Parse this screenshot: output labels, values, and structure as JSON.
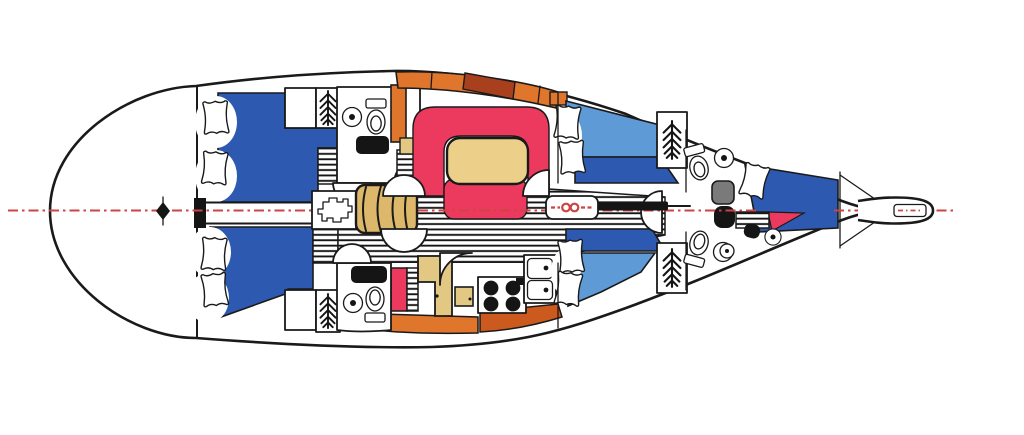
{
  "meta": {
    "title": "Sailboat interior accommodation plan (top view, bow right)",
    "diagram_type": "yacht-deck-plan"
  },
  "colors": {
    "hull_line": "#1a1a1a",
    "berth_dark_blue": "#2d5ab0",
    "berth_light_blue": "#5e9bd6",
    "settee_crimson": "#ec3a5e",
    "locker_crimson": "#ec3a5e",
    "triangle_crimson": "#ec3a5e",
    "table_tan": "#ecd089",
    "nav_tan": "#e3c883",
    "steps_tan": "#ddb76a",
    "cabinet_orange": "#e0752c",
    "counter_rust": "#cc5a1f",
    "cabinet_brown": "#a8401e",
    "shower_gray": "#7a7a7a",
    "centerline_red": "#cc4444",
    "floor_stripe": "#161616"
  },
  "regions": {
    "aft_deck": "aft-deck",
    "aft_cabin_top": "aft-double-cabin-top",
    "aft_cabin_bottom": "aft-double-cabin-bottom",
    "aft_head_top": "aft-head-top",
    "head_bottom": "head-bottom-galley-side",
    "saloon": "saloon-settee-and-table",
    "galley": "galley",
    "nav_station": "nav-station",
    "companionway": "companionway-steps",
    "engine_hatch": "engine-hatch",
    "mast_step": "mast-step",
    "fwd_cabin_top": "forward-cabin-top",
    "fwd_cabin_bottom": "forward-cabin-bottom",
    "fwd_head_top": "forward-head-top",
    "fwd_head_bottom": "forward-head-bottom",
    "forepeak": "forepeak-v-berth",
    "bow_fitting": "bowsprit-anchor-fitting",
    "centerline": "hull-centerline",
    "rudder_post": "rudder-post-marker",
    "hanging_locker_symbol": "fern-hanging-locker-icon",
    "floorboards": "striped-cabin-sole"
  }
}
